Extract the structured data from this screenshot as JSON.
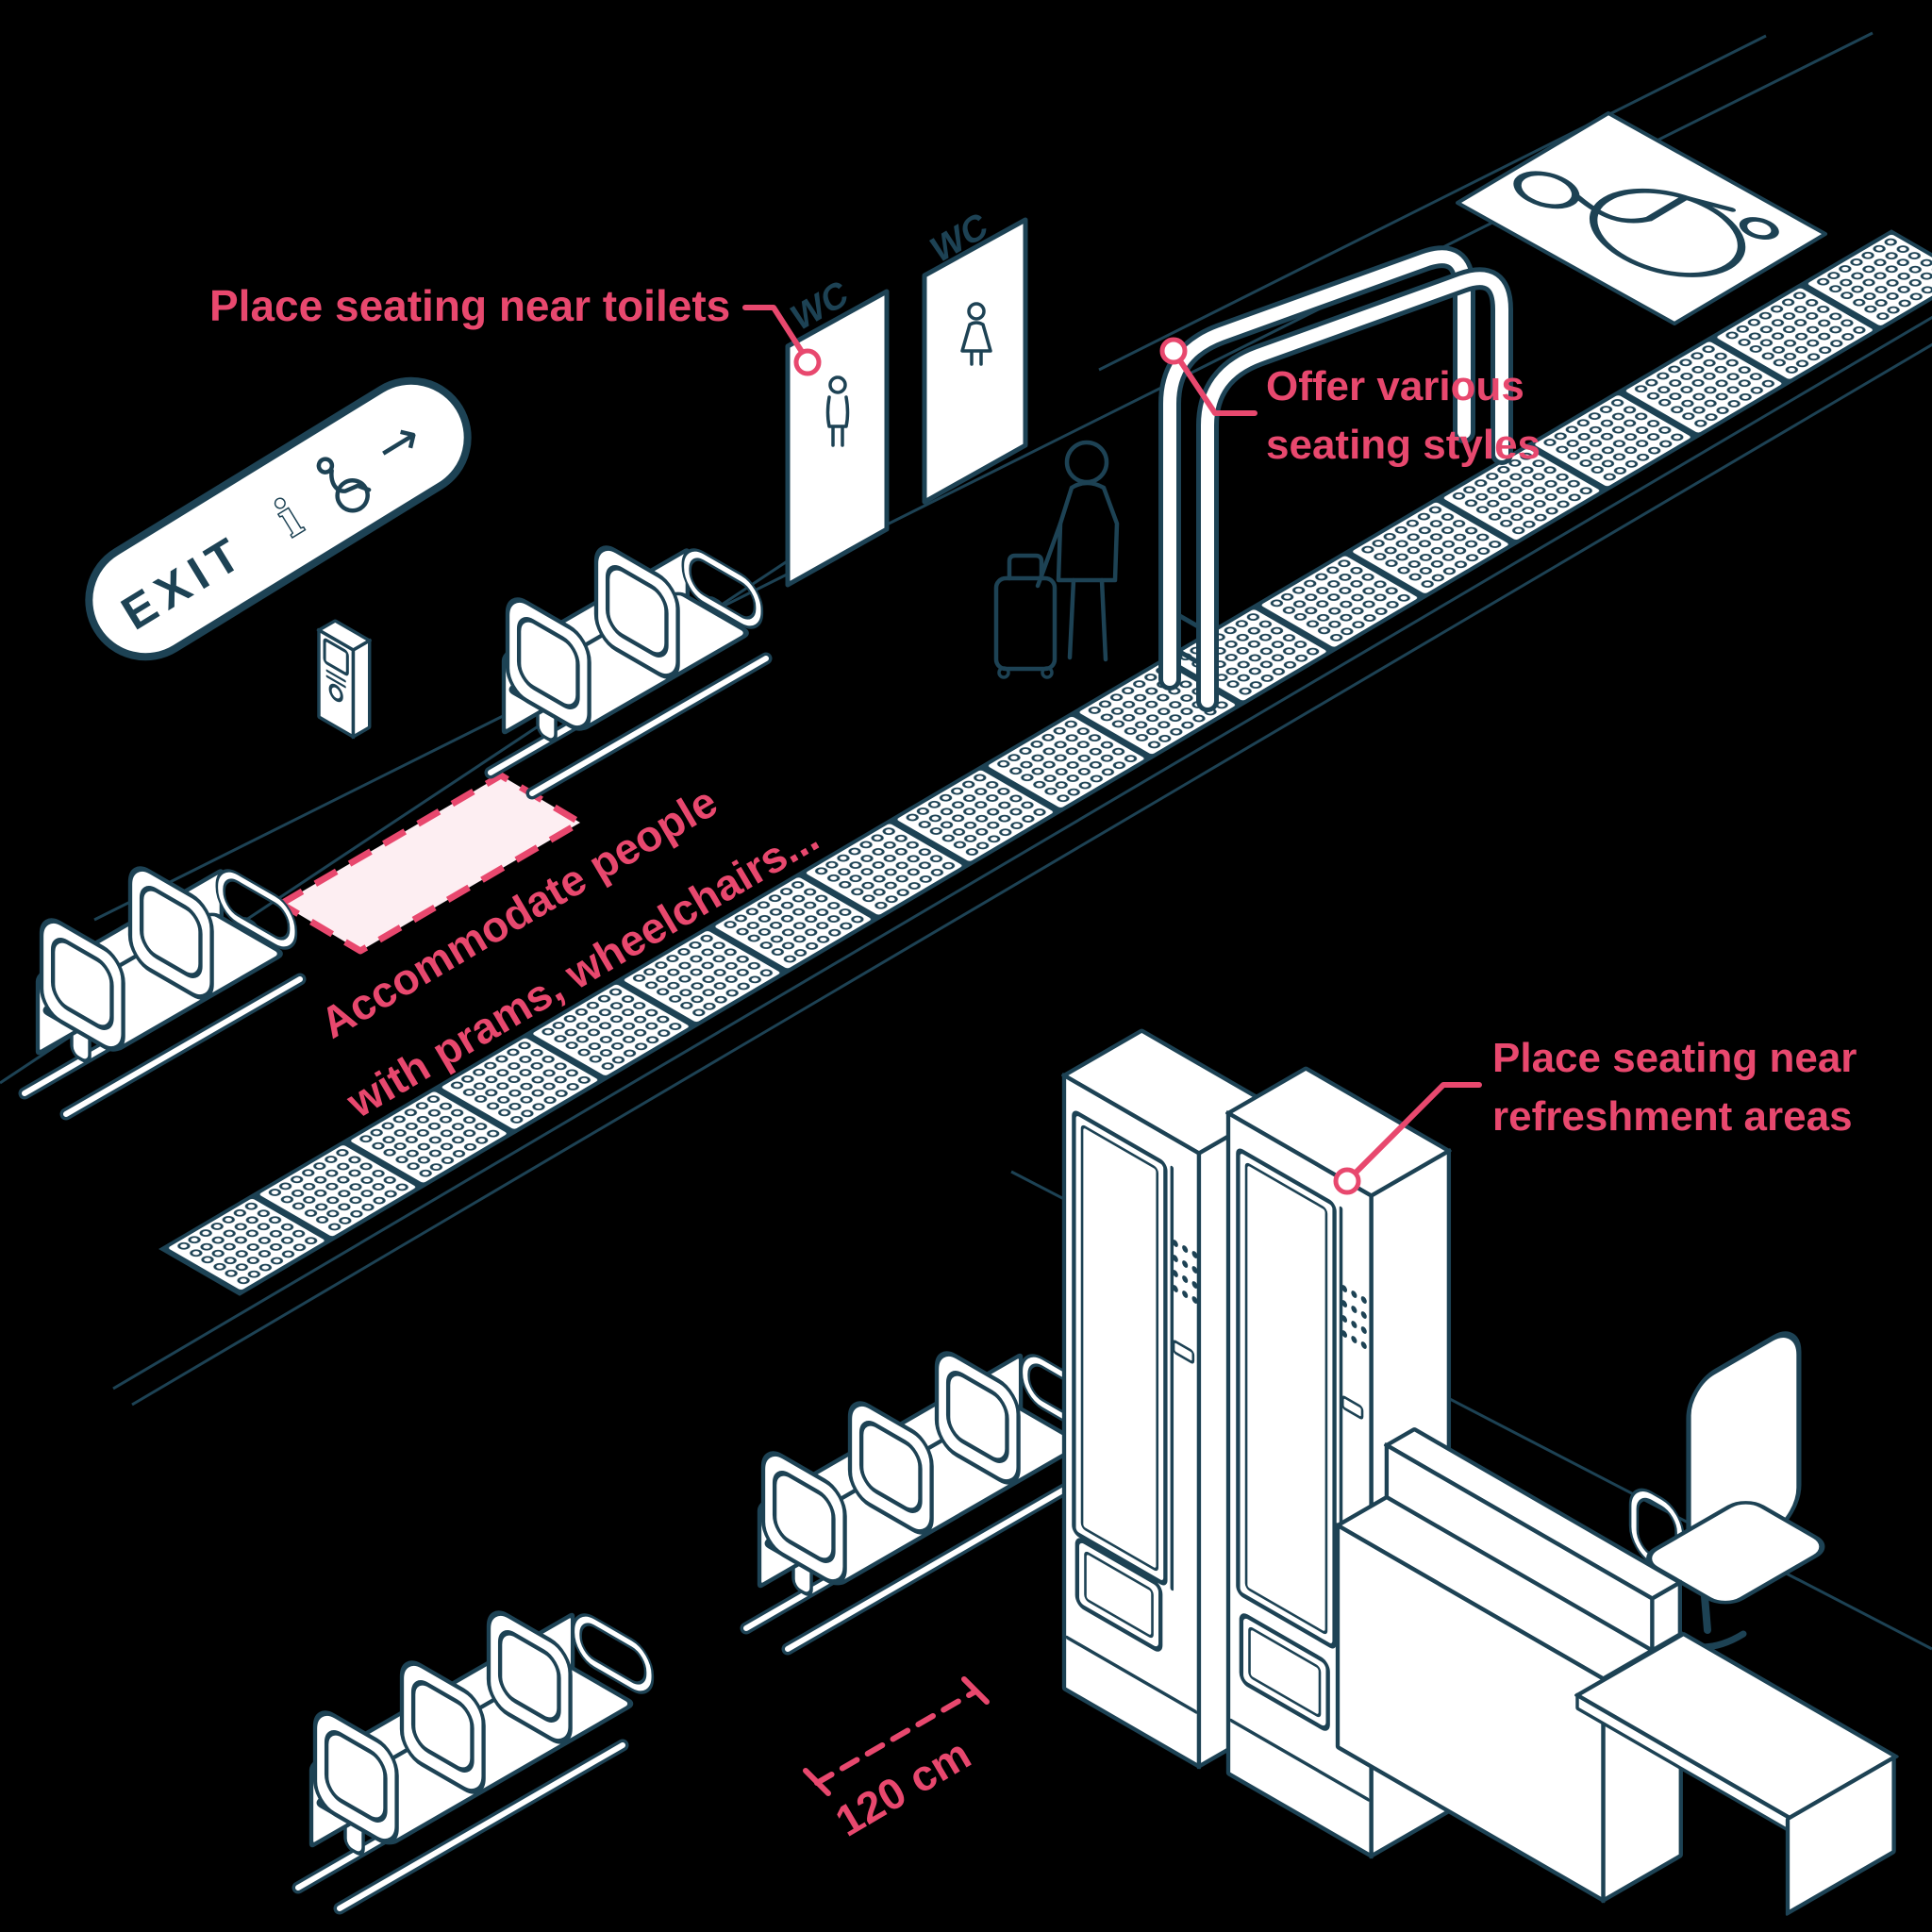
{
  "colors": {
    "background": "#000000",
    "line": "#1d4254",
    "accent_pink": "#e8486e",
    "accent_pink_light": "#fdeef2",
    "white": "#ffffff"
  },
  "annotations": {
    "toilets": {
      "text": "Place seating near toilets"
    },
    "seating_styles": {
      "line1": "Offer various",
      "line2": "seating styles"
    },
    "accommodate": {
      "line1": "Accommodate people",
      "line2": "with prams,  wheelchairs..."
    },
    "refreshment": {
      "line1": "Place seating near",
      "line2": "refreshment areas"
    },
    "dimension": {
      "text": "120 cm"
    }
  },
  "signs": {
    "exit": {
      "text": "EXIT",
      "info_icon": "i",
      "arrow_icon": "→"
    },
    "wc_men": {
      "text": "WC"
    },
    "wc_women": {
      "text": "WC"
    }
  }
}
